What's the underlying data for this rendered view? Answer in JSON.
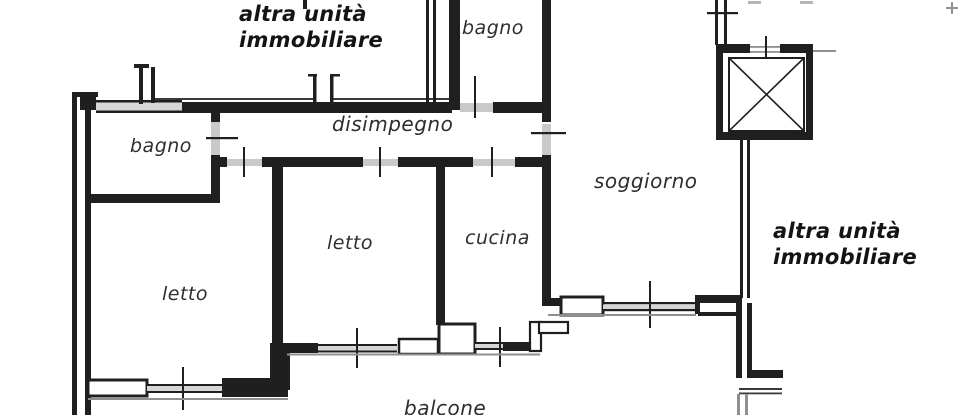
{
  "meta": {
    "type": "floor-plan",
    "language": "it",
    "elevator_symbol": "crossed-box-shaft"
  },
  "colors": {
    "ink": "#1f1f1f",
    "paper": "#ffffff",
    "opening_gray": "#c9c9c9",
    "edge_gray": "#8f8f8f"
  },
  "plan": {
    "room_labels": [
      {
        "id": "bagno-top",
        "label": "bagno"
      },
      {
        "id": "disimpegno",
        "label": "disimpegno"
      },
      {
        "id": "bagno-left",
        "label": "bagno"
      },
      {
        "id": "soggiorno",
        "label": "soggiorno"
      },
      {
        "id": "letto-mid",
        "label": "letto"
      },
      {
        "id": "cucina",
        "label": "cucina"
      },
      {
        "id": "letto-left",
        "label": "letto"
      },
      {
        "id": "balcone",
        "label": "balcone"
      }
    ],
    "neighbor_labels": [
      {
        "id": "altra-unita-top",
        "line1": "altra unità",
        "line2": "immobiliare"
      },
      {
        "id": "altra-unita-right",
        "line1": "altra unità",
        "line2": "immobiliare"
      }
    ]
  }
}
